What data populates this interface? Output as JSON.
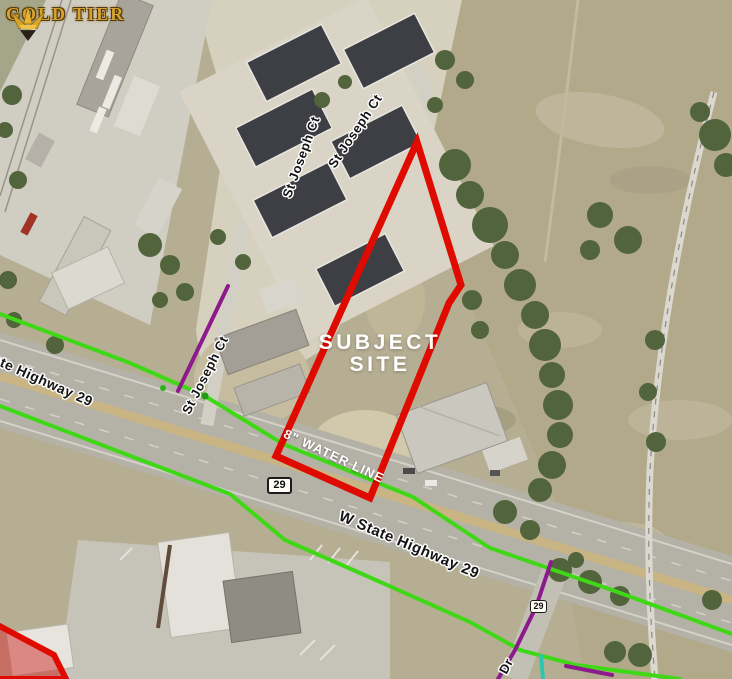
{
  "brand": {
    "name": "GOLD TIER"
  },
  "map": {
    "subject_site_label": "SUBJECT SITE",
    "water_line_label": "8\" WATER LINE",
    "streets": {
      "st_joseph_upper_left": "St Joseph Ct",
      "st_joseph_upper_right": "St Joseph Ct",
      "st_joseph_lower": "St Joseph Ct",
      "state_highway_left": "State Highway 29",
      "state_highway_main": "W State Highway 29",
      "dr_street": "Dr"
    },
    "highway_shields": [
      "29",
      "29"
    ],
    "colors": {
      "subject_boundary": "#e00b00",
      "adjacent_parcel_fill": "#d24f4f",
      "water_line": "#3fd816",
      "utility_purple": "#8c1a8c",
      "utility_teal": "#2cc7ad"
    }
  }
}
